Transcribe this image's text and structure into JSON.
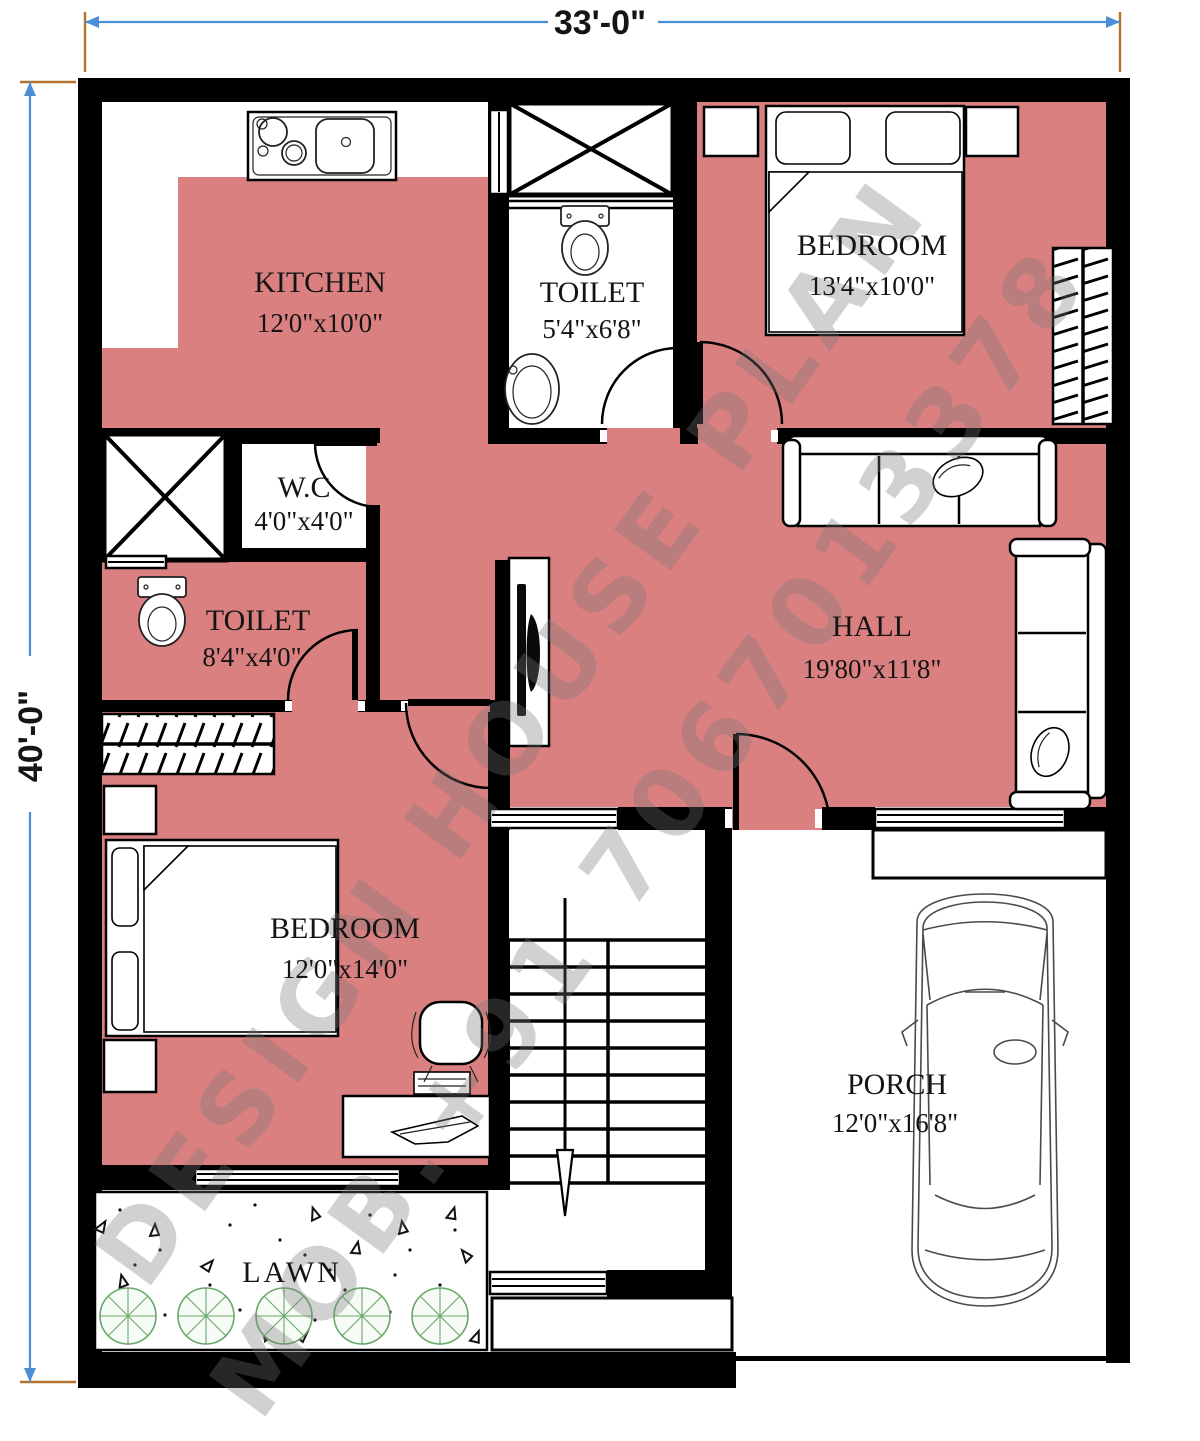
{
  "dimensions": {
    "width": "33'-0\"",
    "height": "40'-0\""
  },
  "watermark": {
    "line1": "DESIGN HOUSE PLAN",
    "line2": "MOB.+91 7067013378"
  },
  "rooms": {
    "kitchen": {
      "name": "KITCHEN",
      "size": "12'0\"x10'0\""
    },
    "toilet_top": {
      "name": "TOILET",
      "size": "5'4\"x6'8\""
    },
    "bedroom_top": {
      "name": "BEDROOM",
      "size": "13'4\"x10'0\""
    },
    "wc": {
      "name": "W.C",
      "size": "4'0\"x4'0\""
    },
    "toilet_left": {
      "name": "TOILET",
      "size": "8'4\"x4'0\""
    },
    "hall": {
      "name": "HALL",
      "size": "19'80\"x11'8\""
    },
    "bedroom_bottom": {
      "name": "BEDROOM",
      "size": "12'0\"x14'0\""
    },
    "porch": {
      "name": "PORCH",
      "size": "12'0\"x16'8\""
    },
    "lawn": {
      "name": "LAWN"
    }
  },
  "colors": {
    "floor": "#DB8080",
    "wall": "#000000",
    "dimension_line": "#4A8FD6",
    "extension_tick": "#B5732C",
    "tree": "#69A869",
    "watermark": "#777777"
  }
}
